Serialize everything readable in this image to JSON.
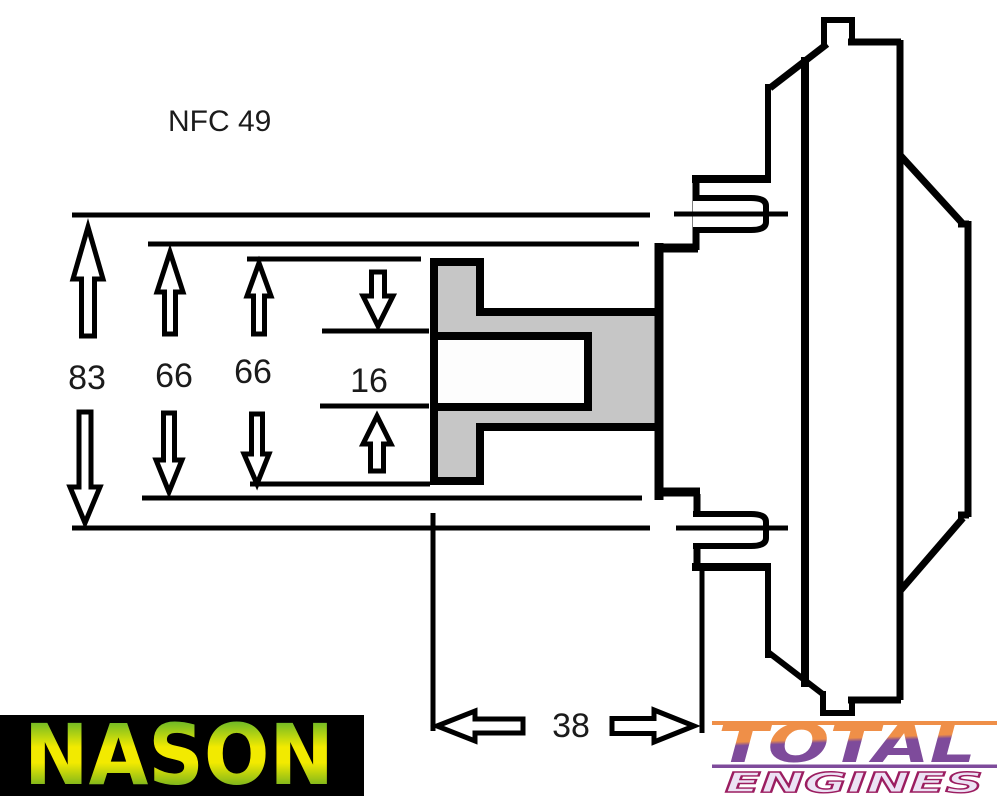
{
  "drawing": {
    "part_code": "NFC 49",
    "dimensions": {
      "outer": "83",
      "mid": "66",
      "inner": "66",
      "slot": "16",
      "depth": "38"
    }
  },
  "branding": {
    "nason": "NASON",
    "total": "TOTAL",
    "engines": "ENGINES"
  },
  "colors": {
    "line": "#000000",
    "hub_fill": "#c6c6c6",
    "nason_green": "#1f9c3d",
    "nason_yellow": "#f2ea00",
    "nason_bg": "#000000",
    "total_orange": "#ef8f48",
    "total_purple": "#7e4b9b",
    "engines_fill": "#ece2f4",
    "engines_outline": "#9b1d60"
  }
}
